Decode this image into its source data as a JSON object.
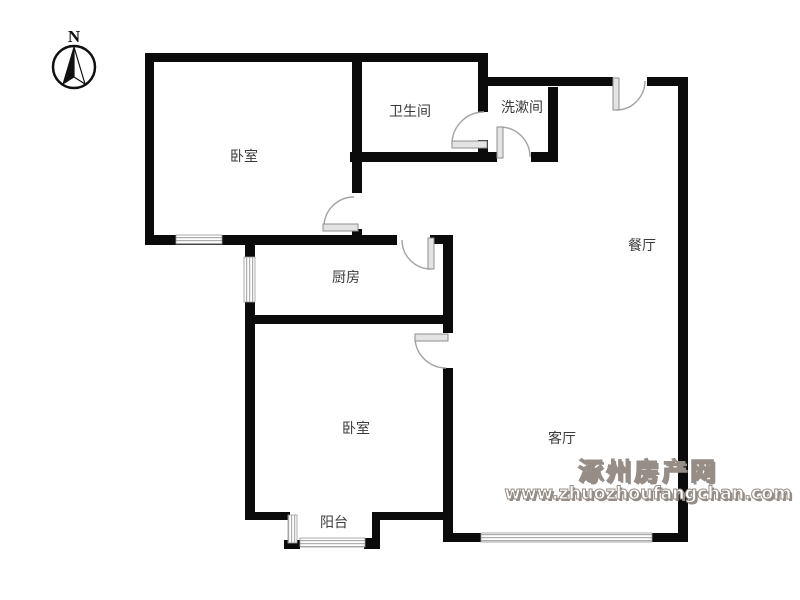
{
  "compass": {
    "label": "N"
  },
  "rooms": [
    {
      "id": "bedroom-1",
      "label": "卧室"
    },
    {
      "id": "bathroom",
      "label": "卫生间"
    },
    {
      "id": "washroom",
      "label": "洗漱间"
    },
    {
      "id": "kitchen",
      "label": "厨房"
    },
    {
      "id": "dining-room",
      "label": "餐厅"
    },
    {
      "id": "bedroom-2",
      "label": "卧室"
    },
    {
      "id": "living-room",
      "label": "客厅"
    },
    {
      "id": "balcony",
      "label": "阳台"
    }
  ],
  "watermark": {
    "site_name": "涿州房产网",
    "site_url": "www.zhuozhoufangchan.com",
    "color": "#958d86"
  },
  "colors": {
    "wall": "#0b0b0b",
    "door": "#a3a3a3",
    "window": "#adadad",
    "label": "#3b3b3b"
  }
}
